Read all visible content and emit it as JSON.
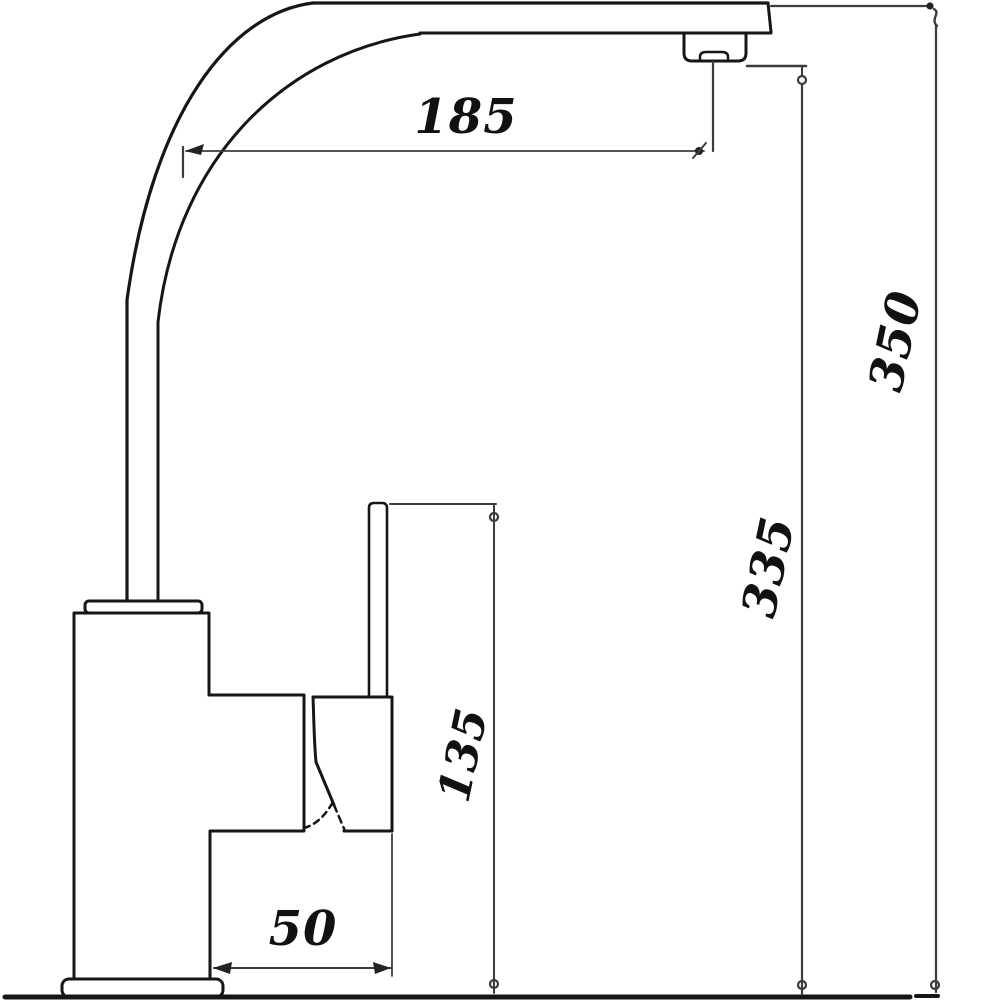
{
  "diagram": {
    "type": "technical-dimension-drawing",
    "subject": "kitchen-faucet-side-view",
    "colors": {
      "background": "#ffffff",
      "outline": "#161616",
      "dimension_line": "#3c3c3c",
      "label_text": "#111111"
    },
    "dimensions": {
      "d185": {
        "value": "185",
        "orientation": "horizontal",
        "measures": "spout-reach-from-bend-to-nozzle"
      },
      "d350": {
        "value": "350",
        "orientation": "rotated-vertical",
        "measures": "total-height-to-spout-top"
      },
      "d335": {
        "value": "335",
        "orientation": "rotated-vertical",
        "measures": "height-to-nozzle-outlet"
      },
      "d135": {
        "value": "135",
        "orientation": "rotated-vertical",
        "measures": "height-to-handle-tip"
      },
      "d50": {
        "value": "50",
        "orientation": "horizontal",
        "measures": "handle-body-offset"
      }
    },
    "parts": [
      "curved-spout",
      "spout-nozzle",
      "riser-pipe",
      "mounting-collar",
      "faucet-body",
      "valve-housing",
      "handle-lever",
      "handle-swing-arc",
      "base-plate",
      "ground-reference-line"
    ]
  }
}
